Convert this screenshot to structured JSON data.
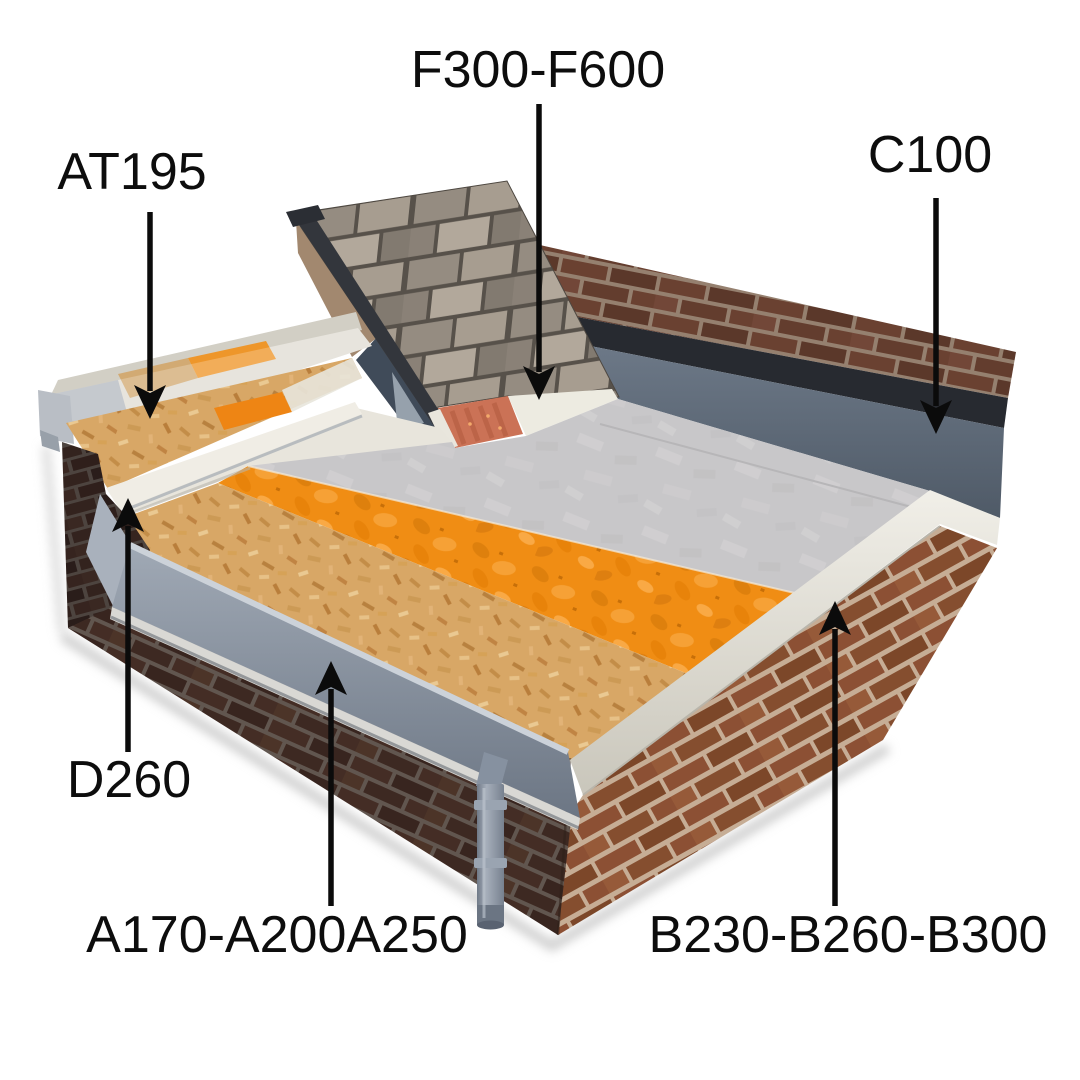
{
  "figure": {
    "type": "roof-construction-cutaway-diagram",
    "background": "#ffffff",
    "label_color": "#0d0d0d"
  },
  "labels": [
    {
      "id": "f300-f600",
      "text": "F300-F600",
      "arrow_direction": "down",
      "points_to": "pitched-roof-eaves-panel"
    },
    {
      "id": "at195",
      "text": "AT195",
      "arrow_direction": "down",
      "points_to": "parapet-coping"
    },
    {
      "id": "c100",
      "text": "C100",
      "arrow_direction": "down",
      "points_to": "membrane-upstand"
    },
    {
      "id": "d260",
      "text": "D260",
      "arrow_direction": "up",
      "points_to": "box-gutter-lining"
    },
    {
      "id": "a170-a200a250",
      "text": "A170-A200A250",
      "arrow_direction": "up",
      "points_to": "front-gutter-fascia"
    },
    {
      "id": "b230-b260-b300",
      "text": "B230-B260-B300",
      "arrow_direction": "up",
      "points_to": "roof-edge-trim"
    }
  ],
  "colors": {
    "membrane_grey": "#c8c7c9",
    "upstand_blue_grey": "#5e6a79",
    "flashing_dark": "#272a30",
    "insulation_orange": "#f08d14",
    "osb_deck_tan": "#d8a766",
    "tiles_slate_grey": "#958c81",
    "eaves_vent_red": "#cb7256",
    "edge_trim_white": "#e8e5dc",
    "gutter_fascia_grey": "#8893a1",
    "brick_front_dark": "#4c332a",
    "brick_right_sunlit": "#8c5034",
    "brick_back": "#6b4232",
    "downpipe_grey": "#8691a0"
  }
}
